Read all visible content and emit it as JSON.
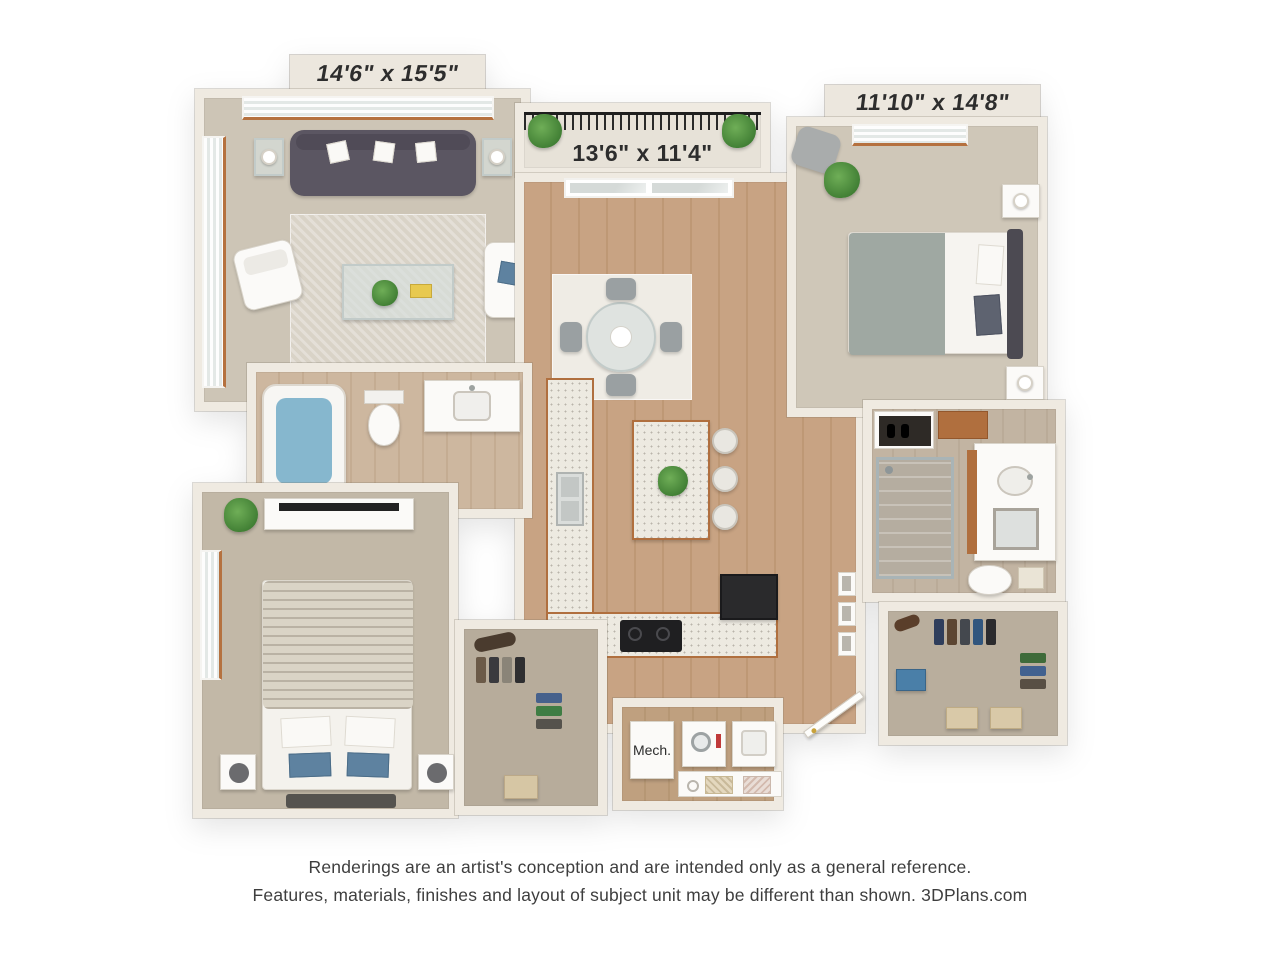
{
  "labels": {
    "living": "14'6\" x 15'5\"",
    "balcony": "13'6\" x 11'4\"",
    "bedroom1": "11'10\" x 14'8\"",
    "mech": "Mech."
  },
  "disclaimer": {
    "line1": "Renderings are an artist's conception and are intended only as a general reference.",
    "line2": "Features, materials, finishes and layout of subject unit may be different than shown. 3DPlans.com"
  },
  "colors": {
    "background": "#FFFFFF",
    "wall": "#EFEAE1",
    "carpet": "#CDC5B6",
    "wood_floor": "#C8A383",
    "wood_trim": "#B06F3E",
    "sofa": "#5B5662",
    "accent_blue": "#5E82A0",
    "plant_green": "#4F8F46",
    "appliance_black": "#232325",
    "label_text": "#2D2D2D",
    "disclaimer_text": "#3E3E3E"
  }
}
